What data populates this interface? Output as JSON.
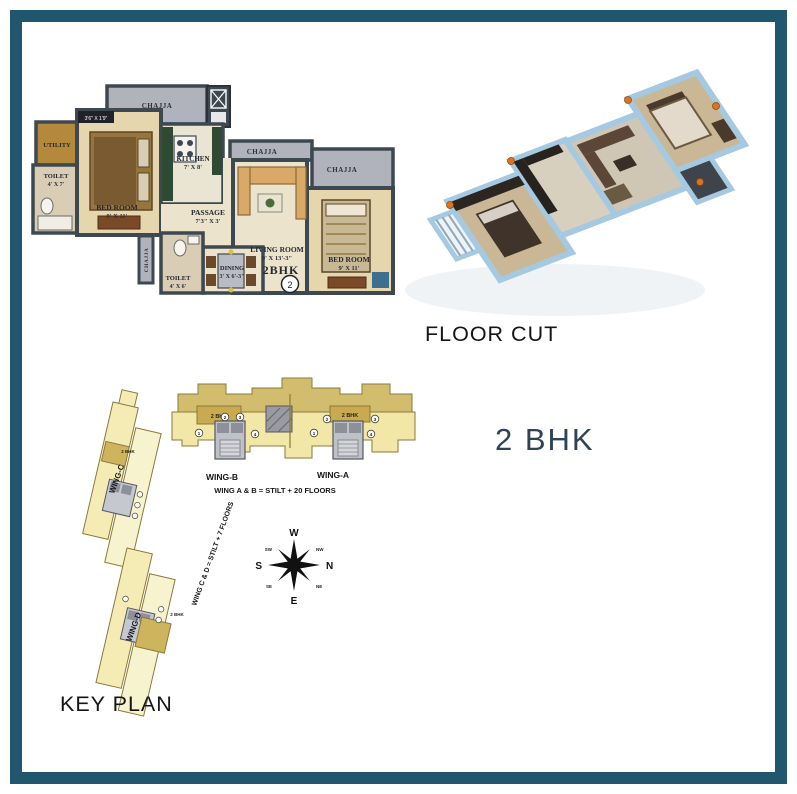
{
  "colors": {
    "frame_teal": "#20576f",
    "accent_navy": "#2e4356",
    "wall_dark": "#3e4850",
    "chajja_gray": "#b0b3bb",
    "keyplan_yellow": "#f2e7a6",
    "keyplan_highlight": "#c9ab4f"
  },
  "headings": {
    "floor_cut": "FLOOR CUT",
    "key_plan": "KEY PLAN",
    "unit_type": "2 BHK"
  },
  "floor_plan": {
    "unit_label": "2BHK",
    "unit_number": "2",
    "niche_dim": "3'6\" X 1'9\"",
    "chajja_labels": [
      "CHAJJA",
      "CHAJJA",
      "CHAJJA",
      "CHAJJA"
    ],
    "rooms": {
      "utility": {
        "name": "UTILITY"
      },
      "toilet_left": {
        "name": "TOILET",
        "dim": "4' X 7'"
      },
      "bedroom_left": {
        "name": "BED ROOM",
        "dim": "9' X 11'"
      },
      "kitchen": {
        "name": "KITCHEN",
        "dim": "7' X 8'"
      },
      "passage": {
        "name": "PASSAGE",
        "dim": "7'3\" X 3'"
      },
      "living_room": {
        "name": "LIVING ROOM",
        "dim": "9' X 13'-3\""
      },
      "dining": {
        "name": "DINING",
        "dim": "3' X 6'-3\""
      },
      "toilet_bottom": {
        "name": "TOILET",
        "dim": "4' X 6'"
      },
      "bedroom_right": {
        "name": "BED ROOM",
        "dim": "9' X 11'"
      }
    }
  },
  "key_plan": {
    "wing_a": "WING-A",
    "wing_b": "WING-B",
    "wing_c": "WING-C",
    "wing_d": "WING-D",
    "note_ab": "WING A & B = STILT + 20 FLOORS",
    "note_cd": "WING C & D = STILT + 7 FLOORS",
    "unit_tags": [
      "2 BHK",
      "2 BHK",
      "2 BHK",
      "2 BHK"
    ],
    "flat_numbers_wing_b": [
      "1",
      "2",
      "3",
      "4"
    ],
    "flat_numbers_wing_a": [
      "1",
      "2",
      "3",
      "4"
    ]
  },
  "compass": {
    "w": "W",
    "n": "N",
    "e": "E",
    "s": "S",
    "nw": "NW",
    "ne": "NE",
    "sw": "SW",
    "se": "SE"
  }
}
